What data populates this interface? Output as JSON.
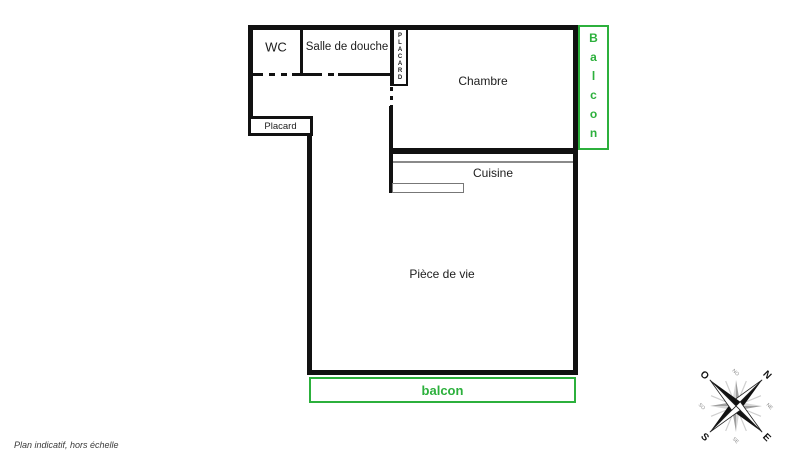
{
  "colors": {
    "wall": "#111111",
    "green": "#2CB03C",
    "line_gray": "#8a8a8a"
  },
  "rooms": {
    "wc": {
      "label": "WC"
    },
    "shower": {
      "label": "Salle de douche"
    },
    "bedroom": {
      "label": "Chambre"
    },
    "kitchen": {
      "label": "Cuisine"
    },
    "living": {
      "label": "Pièce de vie"
    },
    "closet_hall": {
      "label": "Placard"
    },
    "closet_bedroom": {
      "label": "PLACARD"
    }
  },
  "balconies": {
    "right": {
      "label": "Balcon"
    },
    "bottom": {
      "label": "balcon"
    }
  },
  "compass": {
    "n": "N",
    "e": "E",
    "s": "S",
    "o": "O",
    "no": "NO",
    "ne": "NE",
    "se": "SE",
    "so": "SO"
  },
  "footer": {
    "disclaimer": "Plan indicatif, hors échelle"
  }
}
